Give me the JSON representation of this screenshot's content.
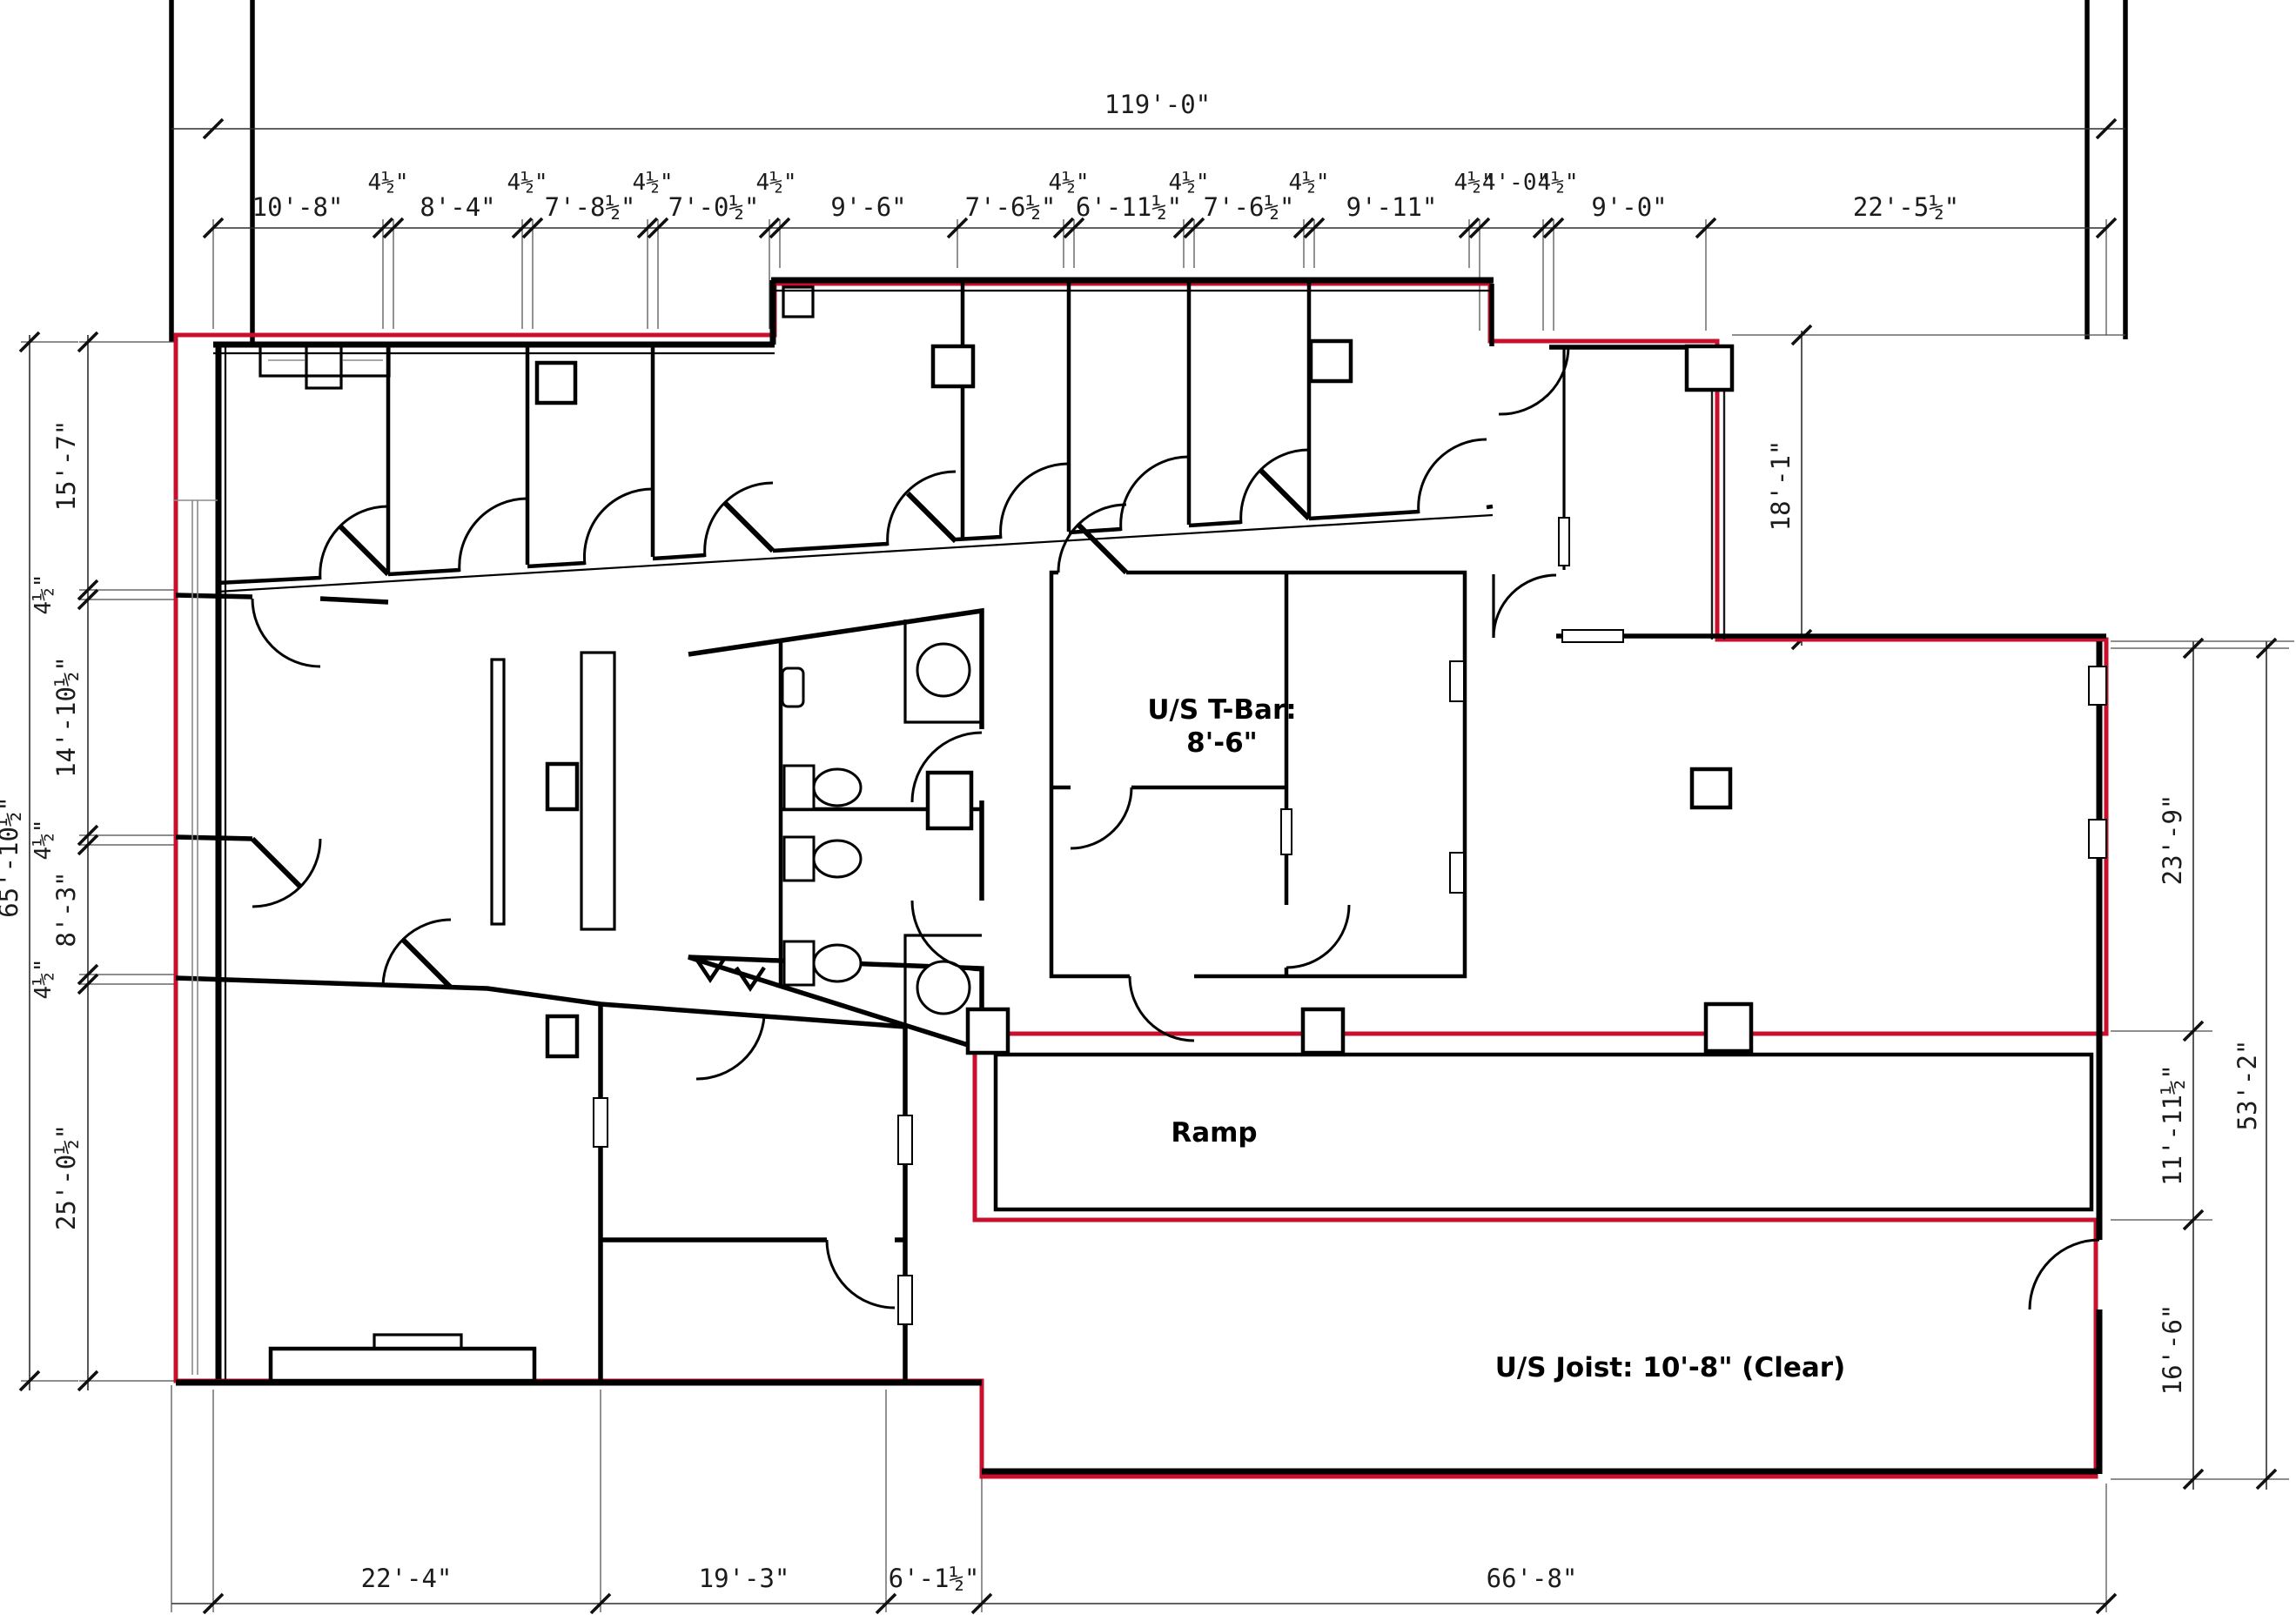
{
  "drawing": {
    "colors": {
      "lease": "#C8102E",
      "wall": "#000000",
      "dim": "#1C1C1C"
    },
    "dims": {
      "top_overall": "119'-0\"",
      "top": [
        "10'-8\"",
        "4½\"",
        "8'-4\"",
        "4½\"",
        "7'-8½\"",
        "4½\"",
        "7'-0½\"",
        "4½\"",
        "9'-6\"",
        "7'-6½\"",
        "4½\"",
        "6'-11½\"",
        "4½\"",
        "7'-6½\"",
        "4½\"",
        "9'-11\"",
        "4½\"",
        "4'-0\"",
        "4½\"",
        "9'-0\"",
        "22'-5½\""
      ],
      "left": [
        "15'-7\"",
        "4½\"",
        "14'-10½\"",
        "4½\"",
        "8'-3\"",
        "4½\"",
        "25'-0½\""
      ],
      "left_overall": "65'-10½\"",
      "right": [
        "23'-9\"",
        "11'-11½\"",
        "16'-6\""
      ],
      "right_overall": "53'-2\"",
      "wing": "18'-1\"",
      "bottom": [
        "22'-4\"",
        "19'-3\"",
        "6'-1½\"",
        "66'-8\""
      ]
    },
    "labels": {
      "tbar1": "U/S T-Bar:",
      "tbar2": "8'-6\"",
      "ramp": "Ramp",
      "joist": "U/S Joist:  10'-8\" (Clear)"
    }
  }
}
